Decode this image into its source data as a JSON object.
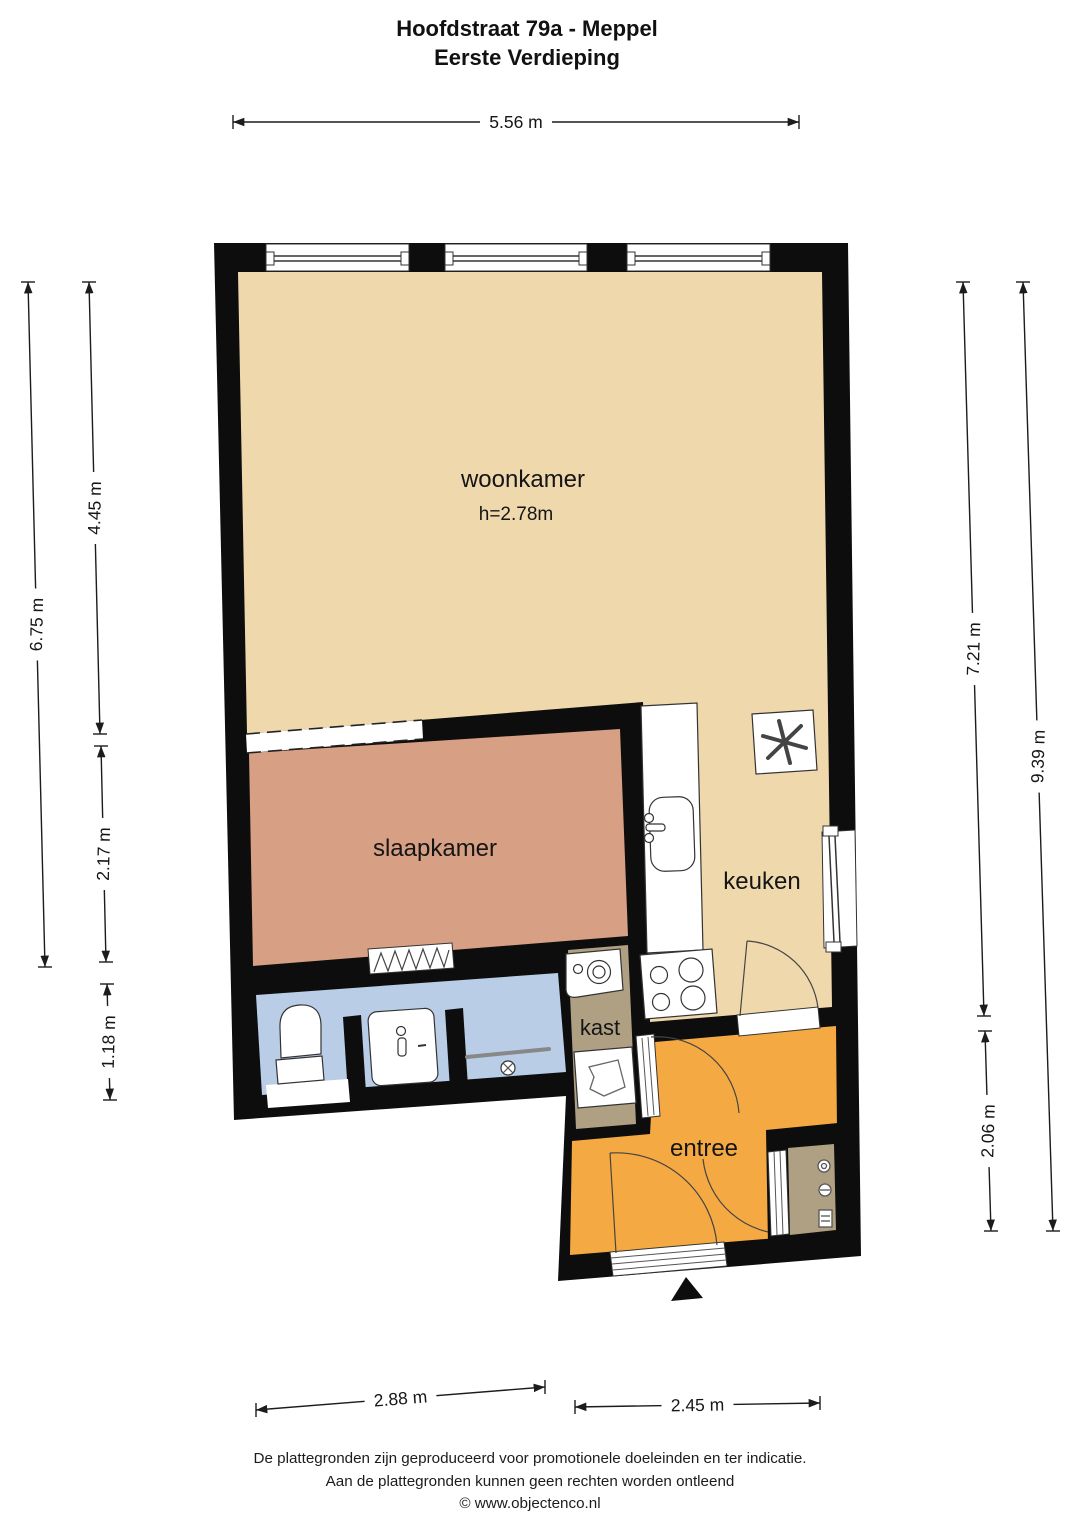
{
  "title": {
    "line1": "Hoofdstraat 79a - Meppel",
    "line2": "Eerste Verdieping"
  },
  "rooms": {
    "woonkamer": {
      "label": "woonkamer",
      "ceiling_height": "h=2.78m",
      "floor_color": "#F0D8AD"
    },
    "slaapkamer": {
      "label": "slaapkamer",
      "floor_color": "#D79F83"
    },
    "keuken": {
      "label": "keuken",
      "floor_color": "#F0D8AD"
    },
    "kast": {
      "label": "kast",
      "floor_color": "#AFA083"
    },
    "entree": {
      "label": "entree",
      "floor_color": "#F5A942"
    },
    "badkamer": {
      "floor_color": "#B9CDE7"
    },
    "meterkast": {
      "floor_color": "#AFA083"
    }
  },
  "dimensions": {
    "top": "5.56 m",
    "left_inner_upper": "4.45 m",
    "left_outer": "6.75 m",
    "left_inner_middle": "2.17 m",
    "left_inner_lower": "1.18 m",
    "right_inner": "7.21 m",
    "right_outer": "9.39 m",
    "right_lower": "2.06 m",
    "bottom_left": "2.88 m",
    "bottom_right": "2.45 m"
  },
  "fixtures": [
    "kitchen-sink",
    "stove",
    "mechanical-ventilation",
    "washing-machine",
    "boiler",
    "toilet",
    "washbasin",
    "shower",
    "radiator",
    "electrical-meter",
    "entrance-arrow",
    "window",
    "door"
  ],
  "footer": {
    "line1": "De plattegronden zijn geproduceerd voor promotionele doeleinden en ter indicatie.",
    "line2": "Aan de plattegronden kunnen geen rechten worden ontleend",
    "line3": "© www.objectenco.nl"
  },
  "colors": {
    "wall": "#0D0D0D",
    "dimension_line": "#1C1C1C",
    "background": "#FFFFFF"
  }
}
